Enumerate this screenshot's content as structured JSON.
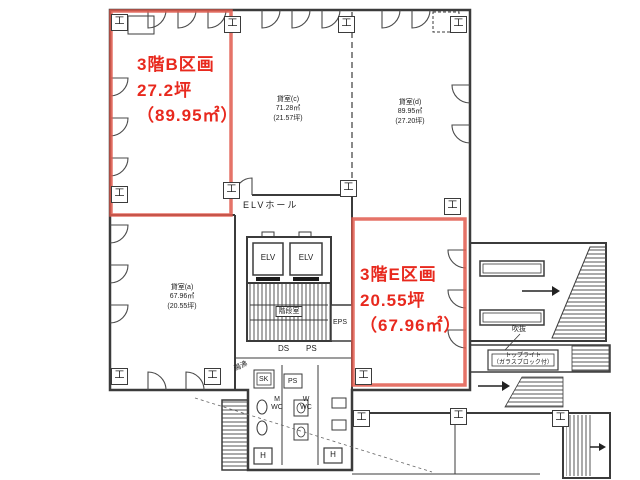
{
  "title_labels": {
    "b_section": {
      "name": "3階B区画",
      "tsubo": "27.2坪",
      "sqm": "（89.95㎡）"
    },
    "e_section": {
      "name": "3階E区画",
      "tsubo": "20.55坪",
      "sqm": "（67.96㎡）"
    }
  },
  "rooms": {
    "a": {
      "name": "貸室(a)",
      "sqm": "67.96㎡",
      "tsubo": "(20.55坪)"
    },
    "c": {
      "name": "貸室(c)",
      "sqm": "71.28㎡",
      "tsubo": "(21.57坪)"
    },
    "d": {
      "name": "貸室(d)",
      "sqm": "89.95㎡",
      "tsubo": "(27.20坪)"
    }
  },
  "core": {
    "elv_hall": "ELVホール",
    "elv": "ELV",
    "stairwell": "階段室",
    "eps": "EPS",
    "ds": "DS",
    "ps": "PS",
    "sk": "SK",
    "m": "M",
    "w": "W",
    "wc": "WC",
    "hot_water": "湯沸",
    "h": "H"
  },
  "annex": {
    "toplight": "トップライト",
    "toplight_sub": "（ガラスブロック付）",
    "void_label": "吹抜"
  },
  "symbols": {
    "column": "工"
  },
  "colors": {
    "red": "#e8291e",
    "red_line": "#e05a4e",
    "wall": "#3b3b3b"
  }
}
